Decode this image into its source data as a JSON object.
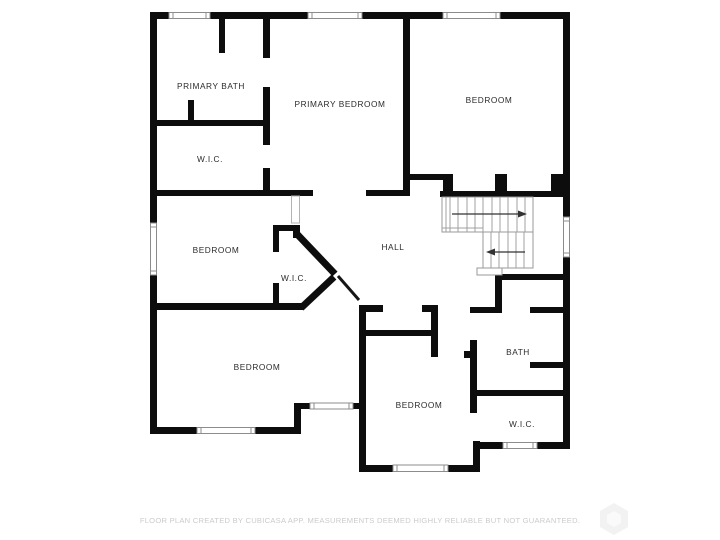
{
  "plan": {
    "type": "floor-plan",
    "rooms": [
      {
        "id": "primary_bath",
        "label": "PRIMARY BATH"
      },
      {
        "id": "wic_primary",
        "label": "W.I.C."
      },
      {
        "id": "primary_bedroom",
        "label": "PRIMARY BEDROOM"
      },
      {
        "id": "bedroom_ne",
        "label": "BEDROOM"
      },
      {
        "id": "bedroom_west",
        "label": "BEDROOM"
      },
      {
        "id": "hall",
        "label": "HALL"
      },
      {
        "id": "wic_hall",
        "label": "W.I.C."
      },
      {
        "id": "bedroom_sw",
        "label": "BEDROOM"
      },
      {
        "id": "bath",
        "label": "BATH"
      },
      {
        "id": "bedroom_south",
        "label": "BEDROOM"
      },
      {
        "id": "wic_se",
        "label": "W.I.C."
      }
    ],
    "stairs": {
      "up_arrow_direction": "right",
      "down_arrow_direction": "left"
    },
    "footer": {
      "disclaimer": "FLOOR PLAN CREATED BY CUBICASA APP. MEASUREMENTS DEEMED HIGHLY RELIABLE BUT NOT GUARANTEED."
    },
    "colors": {
      "wall": "#0d0d0d",
      "room_label": "#2b2b2b",
      "stair_line": "#999999",
      "window_frame": "#8c8c8c",
      "door_mark": "#b3b3b3",
      "footer_text": "#cbcbcb",
      "watermark": "#f2f2f2"
    }
  }
}
